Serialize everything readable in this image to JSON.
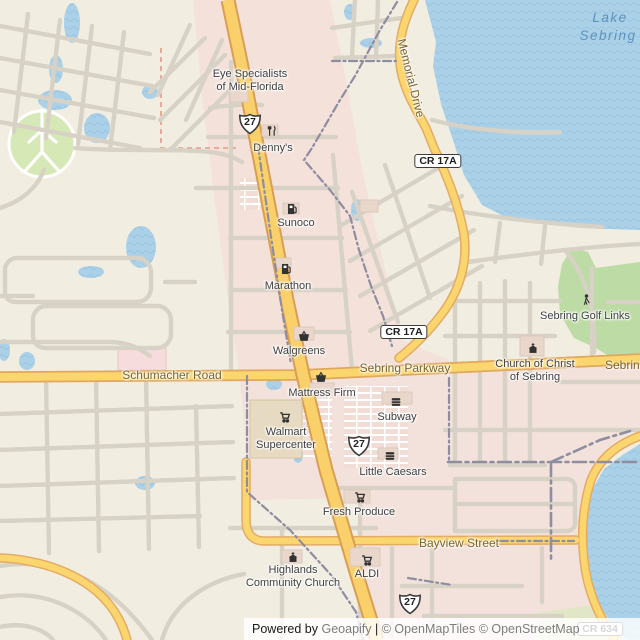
{
  "water_labels": {
    "lake_line1": "Lake",
    "lake_line2": "Sebring"
  },
  "road_labels": {
    "memorial": "Memorial Drive",
    "schumacher": "Schumacher Road",
    "sebring_parkway": "Sebring Parkway",
    "sebring_parkway_edge": "Sebring Parkway",
    "bayview": "Bayview Street"
  },
  "shields": {
    "us27": "27",
    "cr17a": "CR 17A",
    "cr634": "CR 634"
  },
  "pois": {
    "eye_specialists": {
      "line1": "Eye Specialists",
      "line2": "of Mid-Florida"
    },
    "dennys": {
      "label": "Denny's"
    },
    "sunoco": {
      "label": "Sunoco"
    },
    "marathon": {
      "label": "Marathon"
    },
    "walgreens": {
      "label": "Walgreens"
    },
    "mattress_firm": {
      "label": "Mattress Firm"
    },
    "walmart": {
      "line1": "Walmart",
      "line2": "Supercenter"
    },
    "subway": {
      "label": "Subway"
    },
    "little_caesars": {
      "label": "Little Caesars"
    },
    "fresh_produce": {
      "label": "Fresh Produce"
    },
    "aldi": {
      "label": "ALDI"
    },
    "highlands_church": {
      "line1": "Highlands",
      "line2": "Community Church"
    },
    "church_of_christ": {
      "line1": "Church of Christ",
      "line2": "of Sebring"
    },
    "golf_links": {
      "label": "Sebring Golf Links"
    }
  },
  "attribution": {
    "p1": "Powered by ",
    "p2": "Geoapify",
    "p3": " | ",
    "p4": "© OpenMapTiles © OpenStreetMap",
    "p5": " contributors"
  },
  "colors": {
    "water": "#abd1e8",
    "land": "#f1ede1",
    "urban_pink": "#f4e2da",
    "golf_green": "#bddba4",
    "road_yellow": "#fbd66e",
    "boundary_gray": "#8f8da0"
  }
}
